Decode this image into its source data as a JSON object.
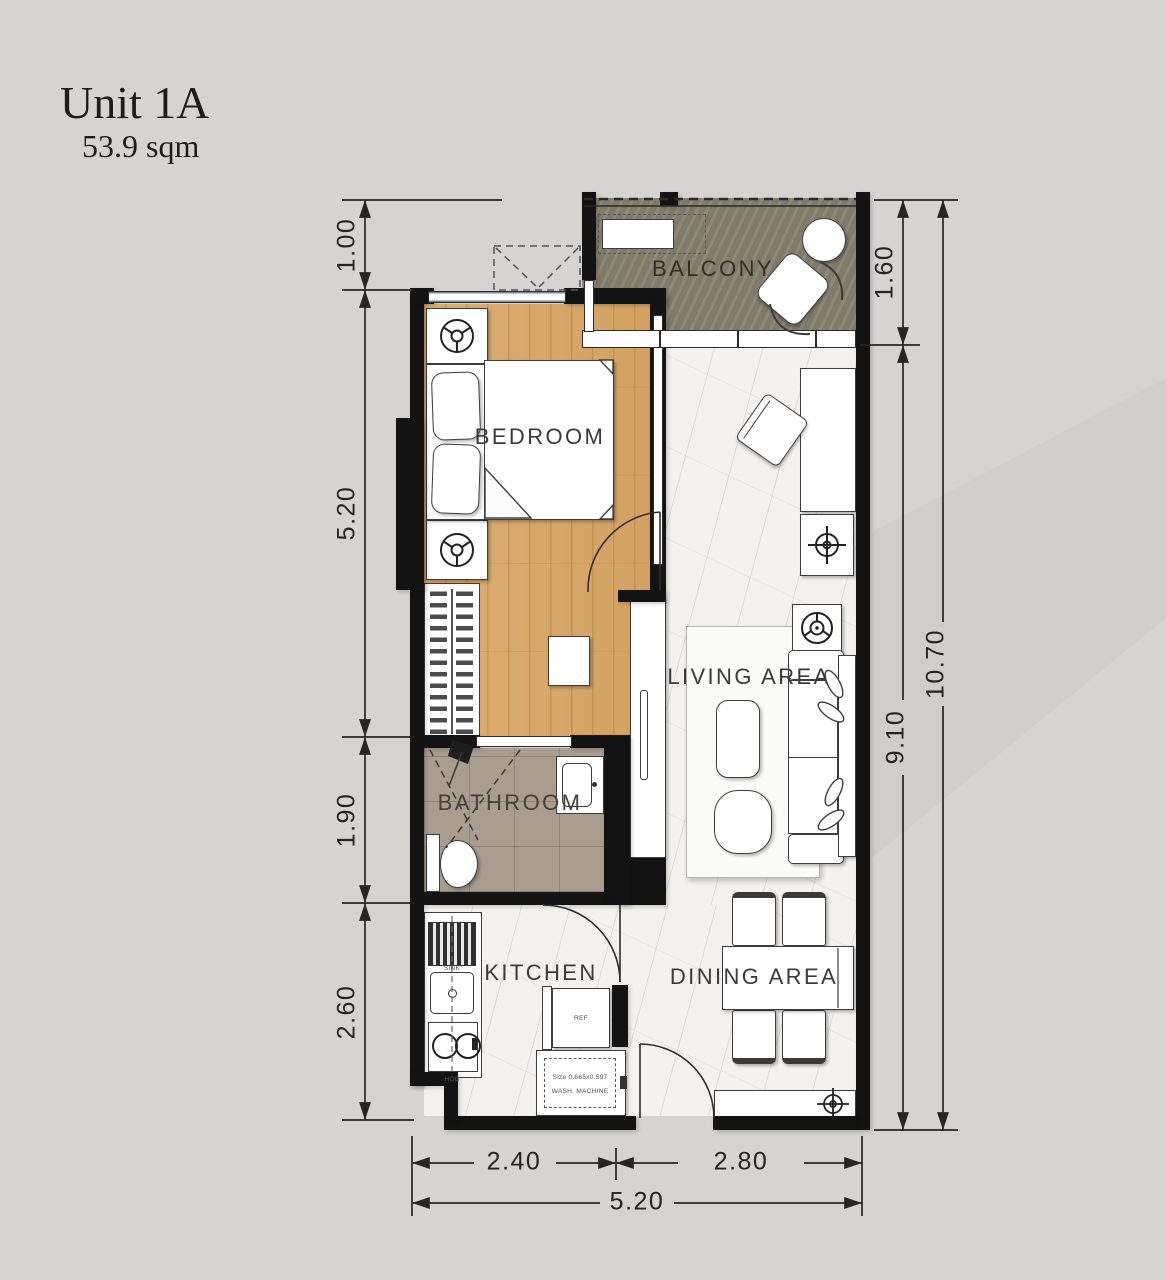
{
  "title": {
    "unit": "Unit 1A",
    "area": "53.9 sqm"
  },
  "rooms": {
    "balcony": "BALCONY",
    "bedroom": "BEDROOM",
    "living": "LIVING AREA",
    "bathroom": "BATHROOM",
    "kitchen": "KITCHEN",
    "dining": "DINING AREA"
  },
  "fixtures": {
    "sink": "SINK",
    "hob": "HOB",
    "fridge": "REF",
    "washer_line1": "Size 0.665x0.597",
    "washer_line2": "WASH. MACHINE"
  },
  "dimensions": {
    "left_top": "1.00",
    "left_bedroom": "5.20",
    "left_bathroom": "1.90",
    "left_kitchen": "2.60",
    "right_balcony": "1.60",
    "right_unit": "9.10",
    "right_total": "10.70",
    "bottom_left": "2.40",
    "bottom_right": "2.80",
    "bottom_total": "5.20"
  },
  "colors": {
    "background": "#d5d4d2",
    "wall": "#131313",
    "wood_floor": "#d9aa6c",
    "balcony_floor": "#87816f",
    "bathroom_floor": "#a89d8f",
    "marble_floor": "#f3f2f0",
    "line": "#262626"
  }
}
